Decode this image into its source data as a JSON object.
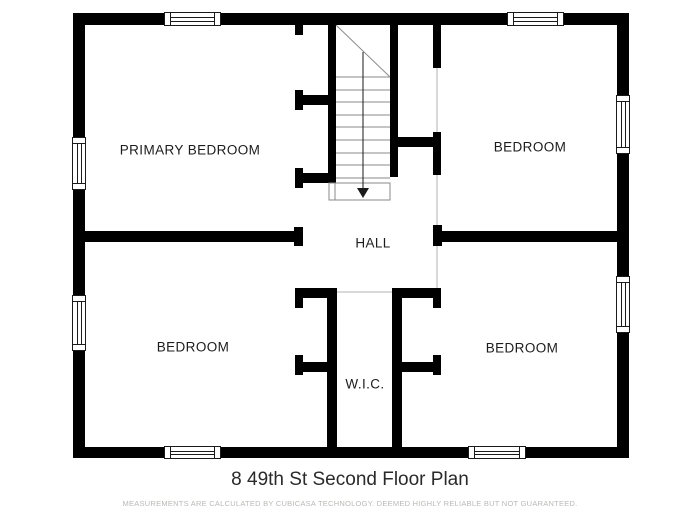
{
  "rooms": {
    "primary_bedroom": {
      "label": "PRIMARY BEDROOM"
    },
    "bedroom_top_right": {
      "label": "BEDROOM"
    },
    "hall": {
      "label": "HALL"
    },
    "bedroom_bottom_left": {
      "label": "BEDROOM"
    },
    "wic": {
      "label": "W.I.C."
    },
    "bedroom_bottom_right": {
      "label": "BEDROOM"
    }
  },
  "stairs": {
    "steps": 9,
    "direction": "down"
  },
  "title": "8 49th St Second Floor Plan",
  "disclaimer": "MEASUREMENTS ARE CALCULATED BY CUBICASA TECHNOLOGY. DEEMED HIGHLY RELIABLE BUT NOT GUARANTEED.",
  "colors": {
    "wall": "#000000",
    "stair_line": "#8a8a8a",
    "arrow": "#1a1a1a",
    "opening_line": "#d8d8d8",
    "label": "#1c1c1c",
    "title": "#2a2a2a",
    "disclaimer": "#b9b9b5"
  }
}
